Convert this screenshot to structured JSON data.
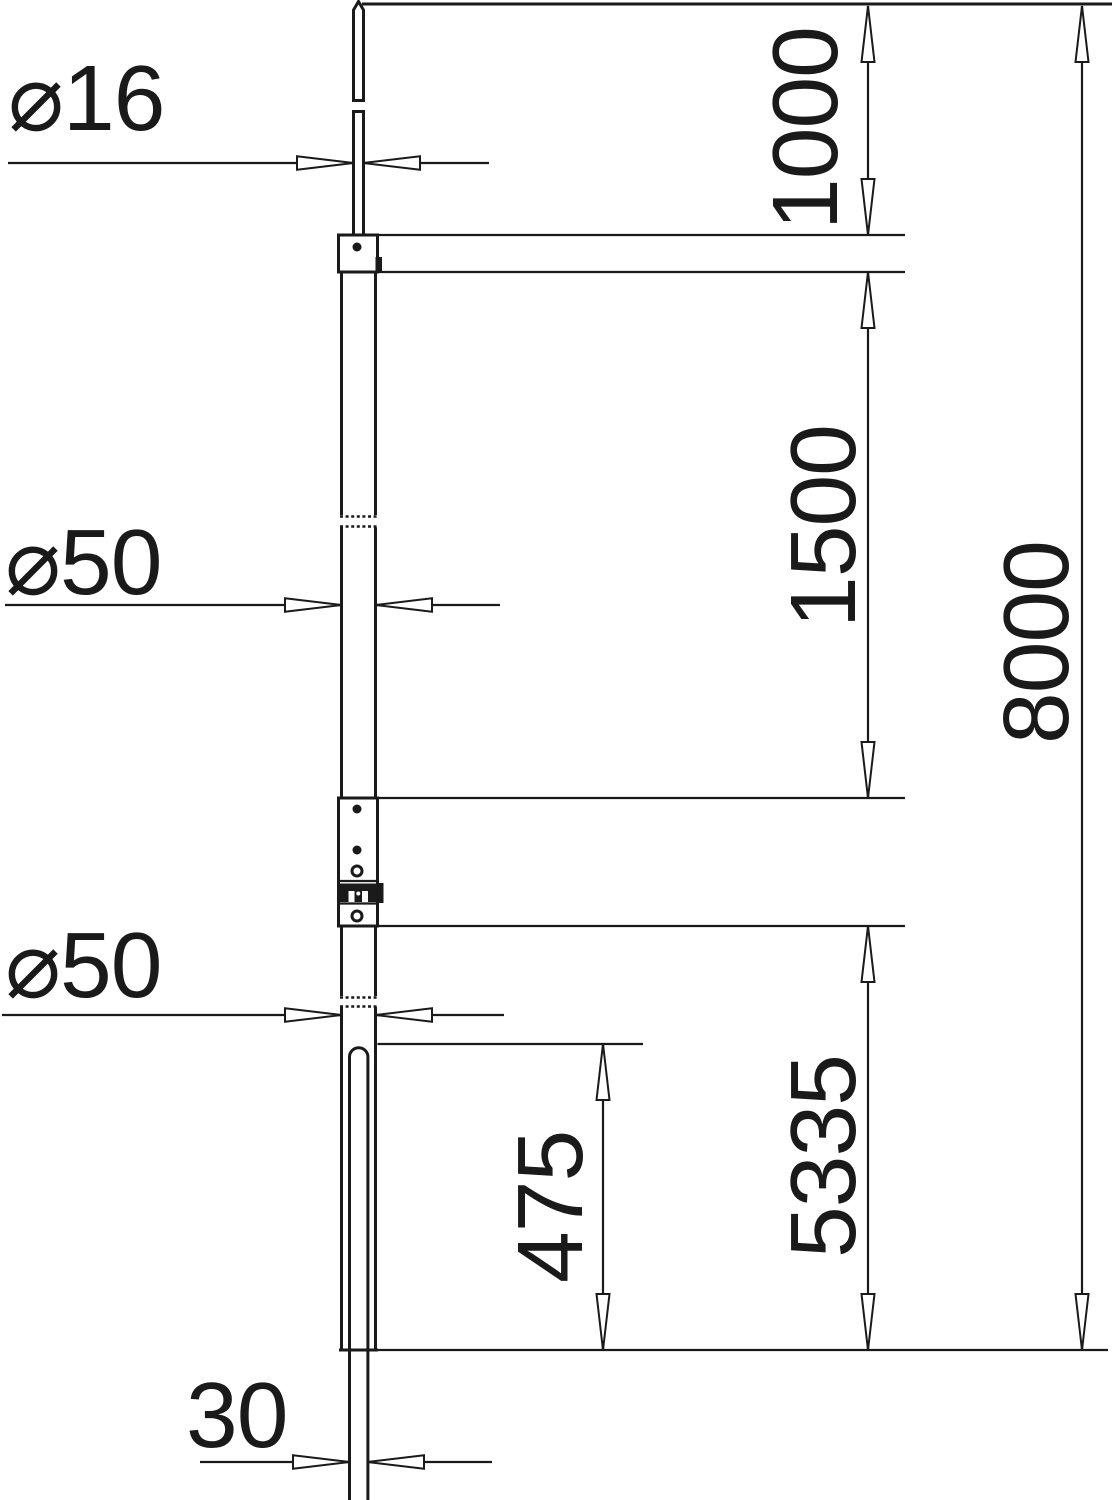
{
  "colors": {
    "ink": "#1a1a1a",
    "bg": "#ffffff"
  },
  "dimensions": {
    "dia_top_rod": "⌀16",
    "dia_upper_tube": "⌀50",
    "dia_lower_tube": "⌀50",
    "width_bottom_rod": "30",
    "len_top_section": "1000",
    "len_upper_tube": "1500",
    "len_lower_section": "5335",
    "len_insertion": "475",
    "len_total": "8000"
  }
}
